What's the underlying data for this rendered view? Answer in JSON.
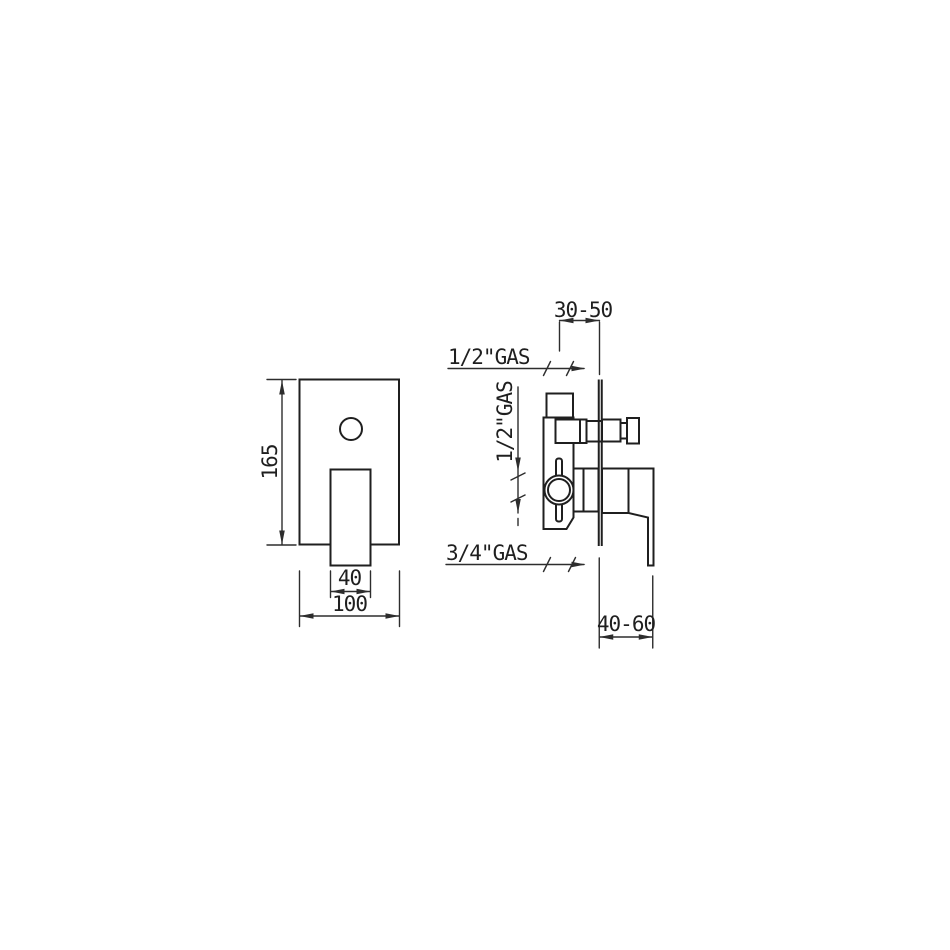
{
  "drawing": {
    "type": "technical-installation-drawing",
    "subject": "concealed-shower-mixer-valve",
    "colors": {
      "line": "#1f1f1f",
      "dimension": "#2d2d2d",
      "background": "#ffffff"
    },
    "front_view": {
      "height_dim": "165",
      "handle_width_dim": "40",
      "plate_width_dim": "100"
    },
    "side_view": {
      "depth_top_dim": "30-50",
      "depth_bottom_dim": "40-60",
      "outlet_top_label": "1/2\"GAS",
      "inlet_side_label": "1/2\"GAS",
      "outlet_bottom_label": "3/4\"GAS"
    }
  }
}
